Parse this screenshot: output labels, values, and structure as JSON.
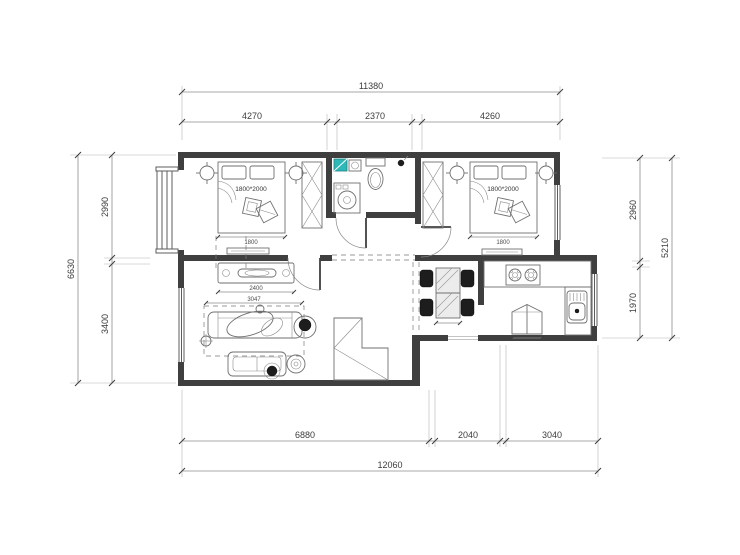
{
  "plan": {
    "title": "apartment-floor-plan",
    "colors": {
      "wall": "#3f3f3f",
      "line": "#6f6f6f",
      "dim": "#8c8c8c",
      "teal": "#2fb8b8",
      "dark": "#1d1d1d",
      "background": "#ffffff"
    },
    "dims": {
      "top_total": "11380",
      "top_seg1": "4270",
      "top_seg2": "2370",
      "top_seg3": "4260",
      "bottom_seg1": "6880",
      "bottom_seg2": "2040",
      "bottom_seg3": "3040",
      "bottom_total": "12060",
      "left_total": "6630",
      "left_seg_top": "2990",
      "left_seg_bottom": "3400",
      "right_seg_top": "2960",
      "right_seg_bottom": "1970",
      "right_total": "5210",
      "bed_left_label": "1800*2000",
      "bed_right_label": "1800*2000",
      "bed_left_width": "1800",
      "bed_right_width": "1800",
      "tv_width": "2400",
      "sofa_width": "3047"
    },
    "furniture_icons": [
      "double-bed",
      "pillow",
      "cushion",
      "nightstand-lamp",
      "wardrobe",
      "wash-basin",
      "washing-machine",
      "toilet",
      "shower-head",
      "tv-console",
      "tv",
      "sofa",
      "chaise",
      "loveseat",
      "coffee-table",
      "side-table",
      "swivel-chair",
      "floor-lamp",
      "plant-pouf",
      "rug",
      "stairs",
      "dining-table",
      "dining-chair",
      "gas-stove",
      "kitchen-sink",
      "refrigerator",
      "kitchen-counter",
      "bay-window",
      "window",
      "door"
    ]
  }
}
